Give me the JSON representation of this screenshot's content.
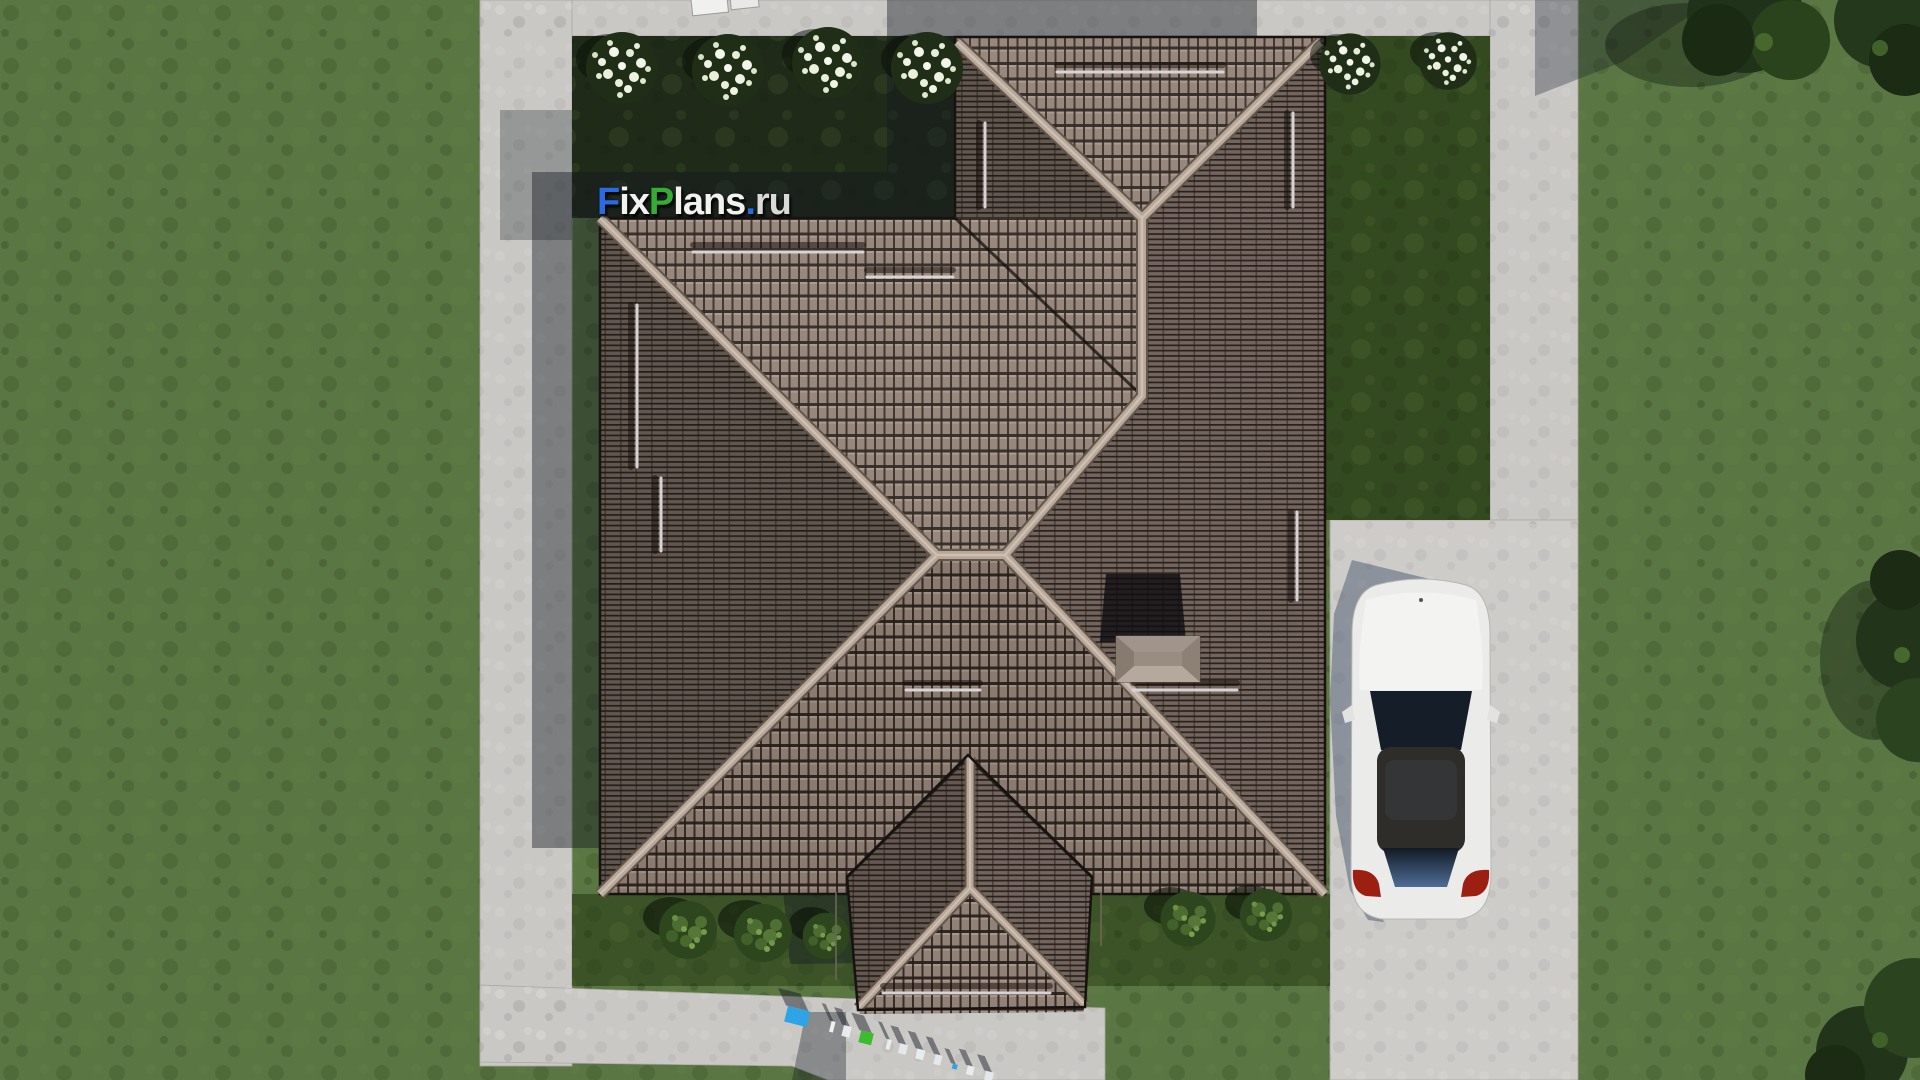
{
  "scene": {
    "description": "Aerial top-down 3D render of a house with a hipped tile roof, lawn, concrete paths, driveway and a parked white car",
    "watermark": {
      "text": "FixPlans.ru",
      "segments": [
        {
          "text": "F",
          "color": "#2a6be4"
        },
        {
          "text": "ix",
          "color": "#f2f2f0"
        },
        {
          "text": "P",
          "color": "#35ad35"
        },
        {
          "text": "lans",
          "color": "#f2f2f0"
        },
        {
          "text": ".",
          "color": "#2a6be4"
        },
        {
          "text": "ru",
          "color": "#d9d9d7"
        }
      ]
    },
    "ground_watermark": {
      "text": "FixPlans.ru"
    },
    "landscape": {
      "white_flower_bushes_top": 4,
      "white_flower_bushes_right": 2,
      "green_bushes_bottom": 5,
      "tree_clusters_top_right": 2,
      "tree_clusters_right_edge": 1,
      "tree_clusters_bottom_right": 1
    },
    "vehicle": {
      "type": "sedan",
      "color": "white"
    },
    "palette": {
      "grass": "#5a7642",
      "garden_shade": "#1f2a18",
      "concrete": "#c9c8c5",
      "roof_tile": "#928177",
      "roof_ridge": "#b7a79b",
      "car_body": "#ebebe9",
      "shadow": "#2a3442"
    }
  }
}
